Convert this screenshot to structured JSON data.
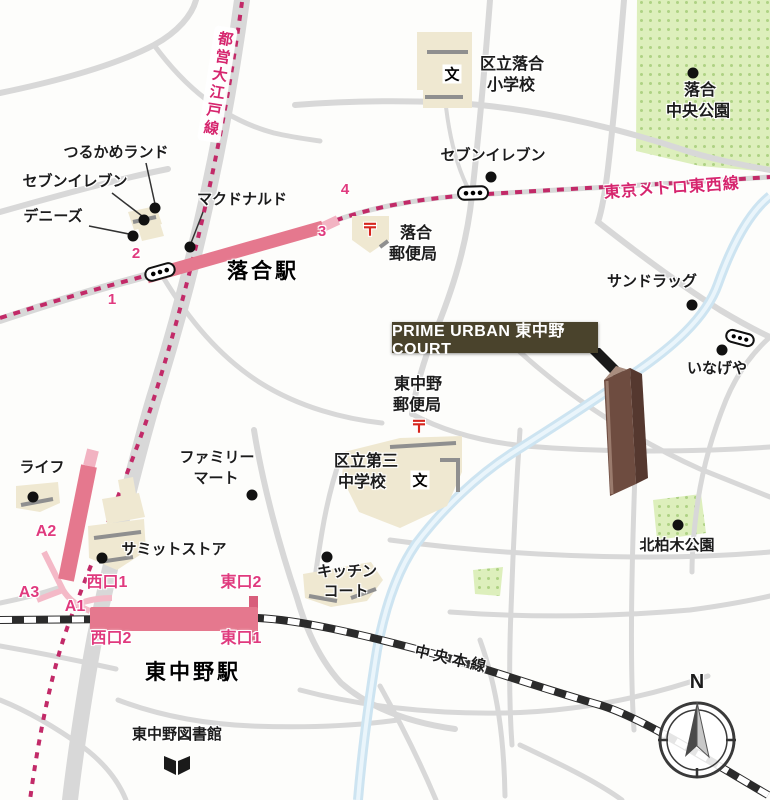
{
  "map": {
    "property_label": "PRIME URBAN 東中野 COURT",
    "compass_north": "N",
    "rail_lines": {
      "toei_oedo": "都営大江戸線",
      "tokyo_metro_tozai": "東京メトロ東西線",
      "chuo_main": "中央本線"
    },
    "stations": {
      "ochiai": "落合駅",
      "higashi_nakano": "東中野駅"
    },
    "exits": {
      "n1": "1",
      "n2": "2",
      "n3": "3",
      "n4": "4",
      "a1": "A1",
      "a2": "A2",
      "a3": "A3",
      "west1": "西口1",
      "west2": "西口2",
      "east1": "東口1",
      "east2": "東口2"
    },
    "pois": {
      "tsurukame_land": "つるかめランド",
      "seven_eleven_w": "セブンイレブン",
      "dennys": "デニーズ",
      "mcdonalds": "マクドナルド",
      "seven_eleven_n": "セブンイレブン",
      "ochiai_elementary_l1": "区立落合",
      "ochiai_elementary_l2": "小学校",
      "ochiai_chuo_park_l1": "落合",
      "ochiai_chuo_park_l2": "中央公園",
      "ochiai_post_l1": "落合",
      "ochiai_post_l2": "郵便局",
      "sundrug": "サンドラッグ",
      "inageya": "いなげや",
      "higashinakano_post_l1": "東中野",
      "higashinakano_post_l2": "郵便局",
      "daisan_jhs_l1": "区立第三",
      "daisan_jhs_l2": "中学校",
      "familymart_l1": "ファミリー",
      "familymart_l2": "マート",
      "life": "ライフ",
      "summit_store": "サミットストア",
      "kitchen_court_l1": "キッチン",
      "kitchen_court_l2": "コート",
      "kitakashiwagi_park": "北柏木公園",
      "higashinakano_library": "東中野図書館"
    },
    "icons": {
      "school": "文",
      "post": "〒"
    },
    "colors": {
      "rail_pink": "#d6256e",
      "station_bar_pink": "#e5788e",
      "exit_pink": "#e03a7e",
      "road_gray": "#d8d8d8",
      "park_green": "#ddefbc",
      "river_blue": "#cde4f1",
      "building_beige": "#efe8d1",
      "label_box_olive": "#4a432c",
      "tower_brown": "#6e4c40",
      "post_red": "#d6251d"
    }
  }
}
